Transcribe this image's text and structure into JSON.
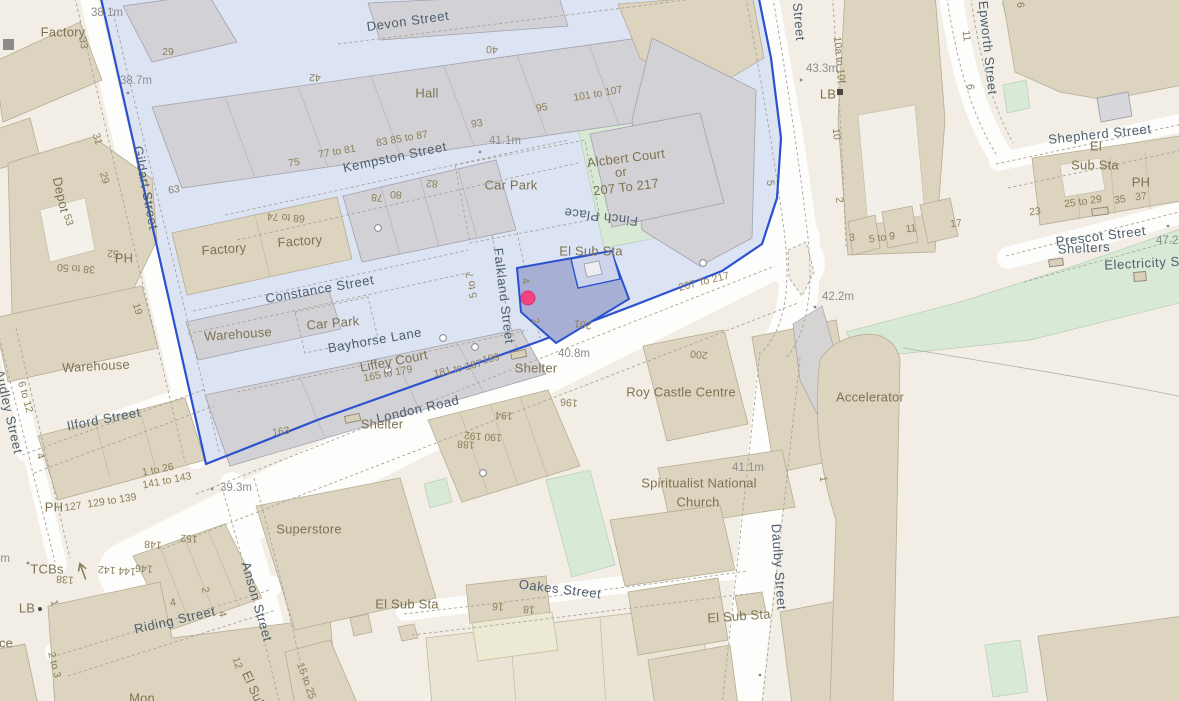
{
  "map": {
    "selection": {
      "boundary_color": "#2b51cf",
      "zone_fill": "#dce3f3",
      "selected_building_fill": "#a8afd4",
      "selected_sub_fill": "#cdd4ec",
      "marker_color": "#f2447e"
    },
    "colors": {
      "background": "#f2eee5",
      "road": "#fdfdfb",
      "building_gray": "#d2d1d5",
      "building_tan": "#dcd4bf",
      "green": "#d8e9d6",
      "street_text": "#4e5e6d",
      "place_text": "#7d7352",
      "number_text": "#8b7f5a",
      "height_text": "#8d8d8d"
    },
    "labels": [
      {
        "t": "Devon Street",
        "x": 408,
        "y": 22,
        "r": -8,
        "c": "s"
      },
      {
        "t": "Kempston Street",
        "x": 395,
        "y": 158,
        "r": -12,
        "c": "s"
      },
      {
        "t": "Gildart Street",
        "x": 145,
        "y": 188,
        "r": 79,
        "c": "s"
      },
      {
        "t": "Constance Street",
        "x": 320,
        "y": 290,
        "r": -10,
        "c": "s"
      },
      {
        "t": "Bayhorse Lane",
        "x": 375,
        "y": 341,
        "r": -10,
        "c": "s"
      },
      {
        "t": "Falkland Street",
        "x": 503,
        "y": 296,
        "r": 83,
        "c": "s"
      },
      {
        "t": "Finch Place",
        "x": 601,
        "y": 216,
        "r": 187,
        "c": "s"
      },
      {
        "t": "London Road",
        "x": 418,
        "y": 410,
        "r": -13,
        "c": "s"
      },
      {
        "t": "Ilford Street",
        "x": 104,
        "y": 420,
        "r": -11,
        "c": "s"
      },
      {
        "t": "Audley Street",
        "x": 8,
        "y": 412,
        "r": 77,
        "c": "s"
      },
      {
        "t": "Anson Street",
        "x": 256,
        "y": 602,
        "r": 74,
        "c": "s"
      },
      {
        "t": "Riding Street",
        "x": 175,
        "y": 621,
        "r": -13,
        "c": "s"
      },
      {
        "t": "Oakes Street",
        "x": 560,
        "y": 590,
        "r": 7,
        "c": "s"
      },
      {
        "t": "Daulby Street",
        "x": 778,
        "y": 567,
        "r": 86,
        "c": "s"
      },
      {
        "t": "Epworth Street",
        "x": 987,
        "y": 48,
        "r": 84,
        "c": "s"
      },
      {
        "t": "Street",
        "x": 798,
        "y": 22,
        "r": 85,
        "c": "s"
      },
      {
        "t": "Shepherd Street",
        "x": 1100,
        "y": 135,
        "r": -6,
        "c": "s"
      },
      {
        "t": "Prescot Street",
        "x": 1101,
        "y": 237,
        "r": -7,
        "c": "s"
      },
      {
        "t": "Shelters",
        "x": 1084,
        "y": 249,
        "r": -3,
        "c": "s"
      },
      {
        "t": "Electricity Su",
        "x": 1146,
        "y": 264,
        "r": -3,
        "c": "s"
      },
      {
        "t": "Factory",
        "x": 63,
        "y": 33,
        "r": 0,
        "c": "p"
      },
      {
        "t": "Hall",
        "x": 427,
        "y": 94,
        "r": 0,
        "c": "p"
      },
      {
        "t": "Car Park",
        "x": 511,
        "y": 186,
        "r": 0,
        "c": "p"
      },
      {
        "t": "Alcbert Court",
        "x": 626,
        "y": 159,
        "r": -7,
        "c": "p"
      },
      {
        "t": "or",
        "x": 621,
        "y": 173,
        "r": -7,
        "c": "p"
      },
      {
        "t": "207 To 217",
        "x": 626,
        "y": 188,
        "r": -7,
        "c": "p"
      },
      {
        "t": "El Sub Sta",
        "x": 591,
        "y": 252,
        "r": 0,
        "c": "p"
      },
      {
        "t": "Factory",
        "x": 224,
        "y": 250,
        "r": -4,
        "c": "p"
      },
      {
        "t": "Factory",
        "x": 300,
        "y": 242,
        "r": -4,
        "c": "p"
      },
      {
        "t": "Warehouse",
        "x": 238,
        "y": 335,
        "r": -4,
        "c": "p"
      },
      {
        "t": "Car Park",
        "x": 333,
        "y": 324,
        "r": -5,
        "c": "p"
      },
      {
        "t": "Depot",
        "x": 60,
        "y": 195,
        "r": 77,
        "c": "p"
      },
      {
        "t": "Warehouse",
        "x": 96,
        "y": 367,
        "r": -3,
        "c": "p"
      },
      {
        "t": "Liffey Court",
        "x": 394,
        "y": 362,
        "r": -11,
        "c": "p"
      },
      {
        "t": "Shelter",
        "x": 536,
        "y": 369,
        "r": 0,
        "c": "p"
      },
      {
        "t": "Shelter",
        "x": 382,
        "y": 425,
        "r": 0,
        "c": "p"
      },
      {
        "t": "Roy Castle Centre",
        "x": 681,
        "y": 393,
        "r": 0,
        "c": "p"
      },
      {
        "t": "Spiritualist National",
        "x": 699,
        "y": 484,
        "r": 0,
        "c": "p"
      },
      {
        "t": "Church",
        "x": 698,
        "y": 503,
        "r": 0,
        "c": "p"
      },
      {
        "t": "Superstore",
        "x": 309,
        "y": 530,
        "r": 0,
        "c": "p"
      },
      {
        "t": "Accelerator",
        "x": 870,
        "y": 398,
        "r": 0,
        "c": "p"
      },
      {
        "t": "El Sub Sta",
        "x": 407,
        "y": 605,
        "r": 0,
        "c": "p"
      },
      {
        "t": "El Sub Sta",
        "x": 739,
        "y": 617,
        "r": -4,
        "c": "p"
      },
      {
        "t": "El Sub",
        "x": 253,
        "y": 690,
        "r": 66,
        "c": "p"
      },
      {
        "t": "TCBs",
        "x": 47,
        "y": 570,
        "r": 0,
        "c": "p"
      },
      {
        "t": "LB",
        "x": 27,
        "y": 609,
        "r": 0,
        "c": "p"
      },
      {
        "t": "LB",
        "x": 828,
        "y": 95,
        "r": 0,
        "c": "p"
      },
      {
        "t": "PH",
        "x": 124,
        "y": 259,
        "r": 0,
        "c": "p"
      },
      {
        "t": "PH",
        "x": 54,
        "y": 508,
        "r": 0,
        "c": "p"
      },
      {
        "t": "PH",
        "x": 1141,
        "y": 183,
        "r": 0,
        "c": "p"
      },
      {
        "t": "El",
        "x": 1096,
        "y": 147,
        "r": 0,
        "c": "p"
      },
      {
        "t": "Sub Sta",
        "x": 1095,
        "y": 166,
        "r": 0,
        "c": "p"
      },
      {
        "t": "Mon",
        "x": 142,
        "y": 699,
        "r": 0,
        "c": "p"
      },
      {
        "t": "ce",
        "x": 6,
        "y": 644,
        "r": 0,
        "c": "p"
      },
      {
        "t": "29",
        "x": 168,
        "y": 52,
        "r": 0,
        "c": "n"
      },
      {
        "t": "42",
        "x": 315,
        "y": 77,
        "r": 184,
        "c": "n"
      },
      {
        "t": "40",
        "x": 492,
        "y": 49,
        "r": 185,
        "c": "n"
      },
      {
        "t": "95",
        "x": 542,
        "y": 108,
        "r": -9,
        "c": "n"
      },
      {
        "t": "101 to 107",
        "x": 598,
        "y": 94,
        "r": -10,
        "c": "n"
      },
      {
        "t": "93",
        "x": 477,
        "y": 124,
        "r": -9,
        "c": "n"
      },
      {
        "t": "83 85 to 87",
        "x": 402,
        "y": 139,
        "r": -10,
        "c": "n"
      },
      {
        "t": "77 to 81",
        "x": 337,
        "y": 152,
        "r": -10,
        "c": "n"
      },
      {
        "t": "75",
        "x": 294,
        "y": 163,
        "r": -10,
        "c": "n"
      },
      {
        "t": "63",
        "x": 174,
        "y": 190,
        "r": -8,
        "c": "n"
      },
      {
        "t": "33",
        "x": 83,
        "y": 43,
        "r": 80,
        "c": "n"
      },
      {
        "t": "53",
        "x": 68,
        "y": 220,
        "r": 74,
        "c": "n"
      },
      {
        "t": "31",
        "x": 97,
        "y": 139,
        "r": 74,
        "c": "n"
      },
      {
        "t": "29",
        "x": 104,
        "y": 178,
        "r": 74,
        "c": "n"
      },
      {
        "t": "19",
        "x": 137,
        "y": 309,
        "r": 74,
        "c": "n"
      },
      {
        "t": "38 to 50",
        "x": 76,
        "y": 268,
        "r": 184,
        "c": "n"
      },
      {
        "t": "52",
        "x": 113,
        "y": 253,
        "r": 184,
        "c": "n"
      },
      {
        "t": "6 to 12",
        "x": 25,
        "y": 397,
        "r": 74,
        "c": "n"
      },
      {
        "t": "4",
        "x": 40,
        "y": 456,
        "r": 74,
        "c": "n"
      },
      {
        "t": "68 to 74",
        "x": 286,
        "y": 217,
        "r": 184,
        "c": "n"
      },
      {
        "t": "78",
        "x": 377,
        "y": 197,
        "r": 184,
        "c": "n"
      },
      {
        "t": "80",
        "x": 396,
        "y": 194,
        "r": 184,
        "c": "n"
      },
      {
        "t": "82",
        "x": 432,
        "y": 183,
        "r": 184,
        "c": "n"
      },
      {
        "t": "5 to 7",
        "x": 472,
        "y": 285,
        "r": -100,
        "c": "n"
      },
      {
        "t": "4",
        "x": 525,
        "y": 281,
        "r": 76,
        "c": "n"
      },
      {
        "t": "2",
        "x": 535,
        "y": 321,
        "r": 76,
        "c": "n"
      },
      {
        "t": "201",
        "x": 583,
        "y": 324,
        "r": 188,
        "c": "n"
      },
      {
        "t": "207 To 217",
        "x": 704,
        "y": 282,
        "r": -14,
        "c": "n"
      },
      {
        "t": "200",
        "x": 699,
        "y": 354,
        "r": 186,
        "c": "n"
      },
      {
        "t": "196",
        "x": 569,
        "y": 402,
        "r": 184,
        "c": "n"
      },
      {
        "t": "194",
        "x": 504,
        "y": 415,
        "r": 184,
        "c": "n"
      },
      {
        "t": "190 192",
        "x": 483,
        "y": 436,
        "r": 184,
        "c": "n"
      },
      {
        "t": "188",
        "x": 466,
        "y": 444,
        "r": 184,
        "c": "n"
      },
      {
        "t": "163",
        "x": 281,
        "y": 432,
        "r": -8,
        "c": "n"
      },
      {
        "t": "181 to 187",
        "x": 458,
        "y": 369,
        "r": -13,
        "c": "n"
      },
      {
        "t": "189",
        "x": 491,
        "y": 359,
        "r": -13,
        "c": "n"
      },
      {
        "t": "165 to 179",
        "x": 388,
        "y": 374,
        "r": -11,
        "c": "n"
      },
      {
        "t": "1 to 26",
        "x": 158,
        "y": 470,
        "r": -11,
        "c": "n"
      },
      {
        "t": "141 to 143",
        "x": 167,
        "y": 481,
        "r": -11,
        "c": "n"
      },
      {
        "t": "127",
        "x": 73,
        "y": 507,
        "r": -8,
        "c": "n"
      },
      {
        "t": "129 to 139",
        "x": 112,
        "y": 501,
        "r": -9,
        "c": "n"
      },
      {
        "t": "152",
        "x": 189,
        "y": 538,
        "r": 184,
        "c": "n"
      },
      {
        "t": "148",
        "x": 153,
        "y": 544,
        "r": 184,
        "c": "n"
      },
      {
        "t": "146",
        "x": 144,
        "y": 568,
        "r": 184,
        "c": "n"
      },
      {
        "t": "144 142",
        "x": 117,
        "y": 570,
        "r": 184,
        "c": "n"
      },
      {
        "t": "138",
        "x": 65,
        "y": 579,
        "r": 184,
        "c": "n"
      },
      {
        "t": "1",
        "x": 54,
        "y": 603,
        "r": 74,
        "c": "n"
      },
      {
        "t": "2 to 3",
        "x": 54,
        "y": 665,
        "r": 76,
        "c": "n"
      },
      {
        "t": "4",
        "x": 173,
        "y": 603,
        "r": -10,
        "c": "n"
      },
      {
        "t": "4",
        "x": 222,
        "y": 614,
        "r": 80,
        "c": "n"
      },
      {
        "t": "2",
        "x": 205,
        "y": 590,
        "r": 78,
        "c": "n"
      },
      {
        "t": "12",
        "x": 237,
        "y": 663,
        "r": 72,
        "c": "n"
      },
      {
        "t": "15 to 25",
        "x": 306,
        "y": 681,
        "r": 70,
        "c": "n"
      },
      {
        "t": "16",
        "x": 498,
        "y": 606,
        "r": 184,
        "c": "n"
      },
      {
        "t": "18",
        "x": 529,
        "y": 609,
        "r": 184,
        "c": "n"
      },
      {
        "t": "10a to 10f",
        "x": 839,
        "y": 60,
        "r": 84,
        "c": "n"
      },
      {
        "t": "10",
        "x": 836,
        "y": 134,
        "r": 84,
        "c": "n"
      },
      {
        "t": "2",
        "x": 839,
        "y": 200,
        "r": 84,
        "c": "n"
      },
      {
        "t": "3",
        "x": 852,
        "y": 238,
        "r": -6,
        "c": "n"
      },
      {
        "t": "5 to 9",
        "x": 882,
        "y": 238,
        "r": -8,
        "c": "n"
      },
      {
        "t": "11",
        "x": 911,
        "y": 229,
        "r": -6,
        "c": "n"
      },
      {
        "t": "17",
        "x": 956,
        "y": 224,
        "r": -6,
        "c": "n"
      },
      {
        "t": "11",
        "x": 966,
        "y": 36,
        "r": 84,
        "c": "n"
      },
      {
        "t": "6",
        "x": 970,
        "y": 87,
        "r": 84,
        "c": "n"
      },
      {
        "t": "6",
        "x": 1020,
        "y": 5,
        "r": 84,
        "c": "n"
      },
      {
        "t": "23",
        "x": 1035,
        "y": 212,
        "r": -6,
        "c": "n"
      },
      {
        "t": "25 to 29",
        "x": 1083,
        "y": 202,
        "r": -8,
        "c": "n"
      },
      {
        "t": "35",
        "x": 1120,
        "y": 200,
        "r": -8,
        "c": "n"
      },
      {
        "t": "37",
        "x": 1141,
        "y": 197,
        "r": -6,
        "c": "n"
      },
      {
        "t": "1",
        "x": 823,
        "y": 479,
        "r": 84,
        "c": "n"
      },
      {
        "t": "5",
        "x": 770,
        "y": 183,
        "r": 84,
        "c": "n"
      },
      {
        "t": "38.1m",
        "x": 107,
        "y": 13,
        "r": 0,
        "c": "h"
      },
      {
        "t": "38.7m",
        "x": 136,
        "y": 81,
        "r": 0,
        "c": "h"
      },
      {
        "t": "41.1m",
        "x": 505,
        "y": 141,
        "r": 0,
        "c": "h"
      },
      {
        "t": "40.8m",
        "x": 574,
        "y": 354,
        "r": 0,
        "c": "h"
      },
      {
        "t": "41.1m",
        "x": 748,
        "y": 468,
        "r": 0,
        "c": "h"
      },
      {
        "t": "39.3m",
        "x": 236,
        "y": 488,
        "r": 0,
        "c": "h"
      },
      {
        "t": "42.2m",
        "x": 838,
        "y": 297,
        "r": 0,
        "c": "h"
      },
      {
        "t": "43.3m",
        "x": 822,
        "y": 69,
        "r": 0,
        "c": "h"
      },
      {
        "t": "47.2m",
        "x": 1172,
        "y": 241,
        "r": 0,
        "c": "h"
      },
      {
        "t": "37.7m",
        "x": -6,
        "y": 559,
        "r": 0,
        "c": "h"
      }
    ]
  }
}
